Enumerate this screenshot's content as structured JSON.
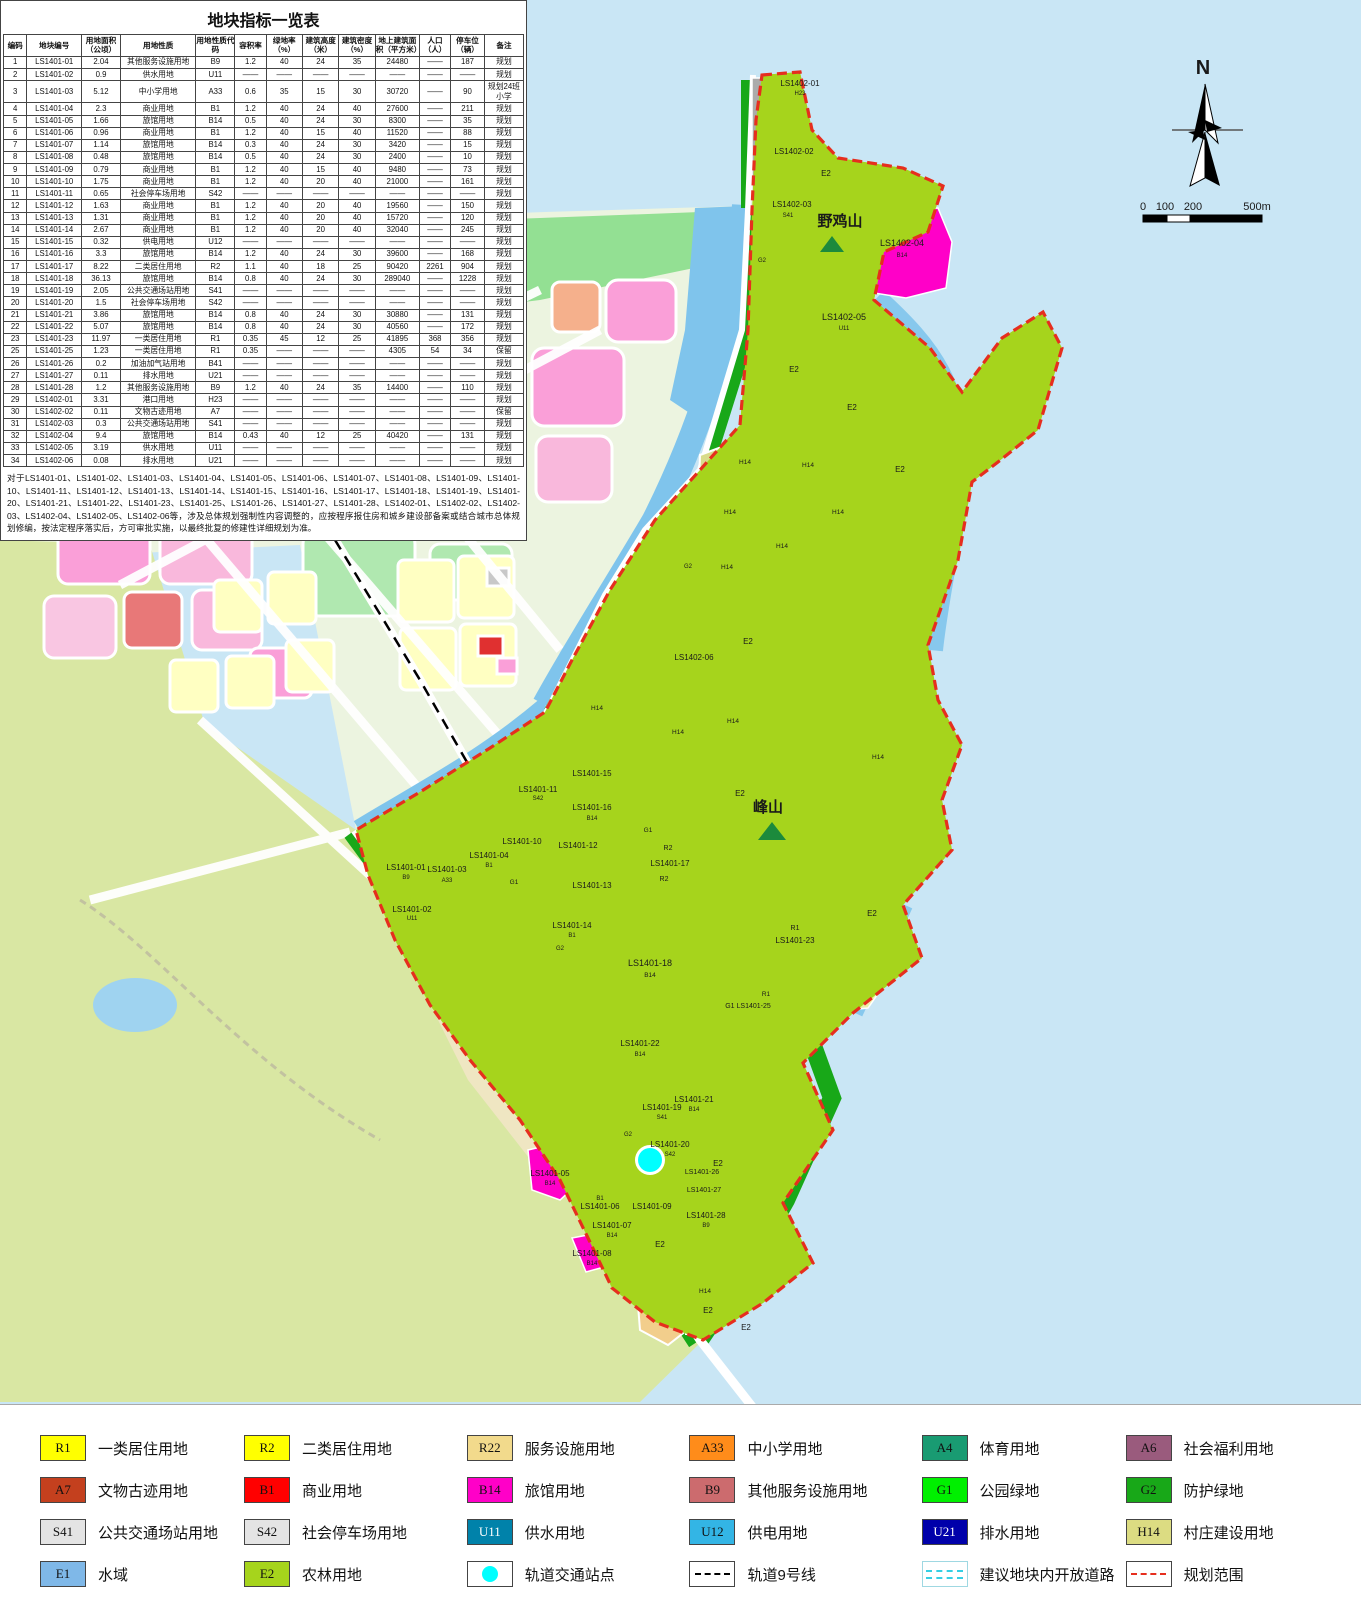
{
  "table": {
    "title": "地块指标一览表",
    "headers": [
      "编码",
      "地块编号",
      "用地面积（公顷）",
      "用地性质",
      "用地性质代码",
      "容积率",
      "绿地率（%）",
      "建筑高度（米）",
      "建筑密度（%）",
      "地上建筑面积（平方米）",
      "人口（人）",
      "停车位（辆）",
      "备注"
    ],
    "rows": [
      [
        "1",
        "LS1401-01",
        "2.04",
        "其他服务设施用地",
        "B9",
        "1.2",
        "40",
        "24",
        "35",
        "24480",
        "——",
        "187",
        "规划"
      ],
      [
        "2",
        "LS1401-02",
        "0.9",
        "供水用地",
        "U11",
        "——",
        "——",
        "——",
        "——",
        "——",
        "——",
        "——",
        "规划"
      ],
      [
        "3",
        "LS1401-03",
        "5.12",
        "中小学用地",
        "A33",
        "0.6",
        "35",
        "15",
        "30",
        "30720",
        "——",
        "90",
        "规划24班小学"
      ],
      [
        "4",
        "LS1401-04",
        "2.3",
        "商业用地",
        "B1",
        "1.2",
        "40",
        "24",
        "40",
        "27600",
        "——",
        "211",
        "规划"
      ],
      [
        "5",
        "LS1401-05",
        "1.66",
        "旅馆用地",
        "B14",
        "0.5",
        "40",
        "24",
        "30",
        "8300",
        "——",
        "35",
        "规划"
      ],
      [
        "6",
        "LS1401-06",
        "0.96",
        "商业用地",
        "B1",
        "1.2",
        "40",
        "15",
        "40",
        "11520",
        "——",
        "88",
        "规划"
      ],
      [
        "7",
        "LS1401-07",
        "1.14",
        "旅馆用地",
        "B14",
        "0.3",
        "40",
        "24",
        "30",
        "3420",
        "——",
        "15",
        "规划"
      ],
      [
        "8",
        "LS1401-08",
        "0.48",
        "旅馆用地",
        "B14",
        "0.5",
        "40",
        "24",
        "30",
        "2400",
        "——",
        "10",
        "规划"
      ],
      [
        "9",
        "LS1401-09",
        "0.79",
        "商业用地",
        "B1",
        "1.2",
        "40",
        "15",
        "40",
        "9480",
        "——",
        "73",
        "规划"
      ],
      [
        "10",
        "LS1401-10",
        "1.75",
        "商业用地",
        "B1",
        "1.2",
        "40",
        "20",
        "40",
        "21000",
        "——",
        "161",
        "规划"
      ],
      [
        "11",
        "LS1401-11",
        "0.65",
        "社会停车场用地",
        "S42",
        "——",
        "——",
        "——",
        "——",
        "——",
        "——",
        "——",
        "规划"
      ],
      [
        "12",
        "LS1401-12",
        "1.63",
        "商业用地",
        "B1",
        "1.2",
        "40",
        "20",
        "40",
        "19560",
        "——",
        "150",
        "规划"
      ],
      [
        "13",
        "LS1401-13",
        "1.31",
        "商业用地",
        "B1",
        "1.2",
        "40",
        "20",
        "40",
        "15720",
        "——",
        "120",
        "规划"
      ],
      [
        "14",
        "LS1401-14",
        "2.67",
        "商业用地",
        "B1",
        "1.2",
        "40",
        "20",
        "40",
        "32040",
        "——",
        "245",
        "规划"
      ],
      [
        "15",
        "LS1401-15",
        "0.32",
        "供电用地",
        "U12",
        "——",
        "——",
        "——",
        "——",
        "——",
        "——",
        "——",
        "规划"
      ],
      [
        "16",
        "LS1401-16",
        "3.3",
        "旅馆用地",
        "B14",
        "1.2",
        "40",
        "24",
        "30",
        "39600",
        "——",
        "168",
        "规划"
      ],
      [
        "17",
        "LS1401-17",
        "8.22",
        "二类居住用地",
        "R2",
        "1.1",
        "40",
        "18",
        "25",
        "90420",
        "2261",
        "904",
        "规划"
      ],
      [
        "18",
        "LS1401-18",
        "36.13",
        "旅馆用地",
        "B14",
        "0.8",
        "40",
        "24",
        "30",
        "289040",
        "——",
        "1228",
        "规划"
      ],
      [
        "19",
        "LS1401-19",
        "2.05",
        "公共交通场站用地",
        "S41",
        "——",
        "——",
        "——",
        "——",
        "——",
        "——",
        "——",
        "规划"
      ],
      [
        "20",
        "LS1401-20",
        "1.5",
        "社会停车场用地",
        "S42",
        "——",
        "——",
        "——",
        "——",
        "——",
        "——",
        "——",
        "规划"
      ],
      [
        "21",
        "LS1401-21",
        "3.86",
        "旅馆用地",
        "B14",
        "0.8",
        "40",
        "24",
        "30",
        "30880",
        "——",
        "131",
        "规划"
      ],
      [
        "22",
        "LS1401-22",
        "5.07",
        "旅馆用地",
        "B14",
        "0.8",
        "40",
        "24",
        "30",
        "40560",
        "——",
        "172",
        "规划"
      ],
      [
        "23",
        "LS1401-23",
        "11.97",
        "一类居住用地",
        "R1",
        "0.35",
        "45",
        "12",
        "25",
        "41895",
        "368",
        "356",
        "规划"
      ],
      [
        "25",
        "LS1401-25",
        "1.23",
        "一类居住用地",
        "R1",
        "0.35",
        "——",
        "——",
        "——",
        "4305",
        "54",
        "34",
        "保留"
      ],
      [
        "26",
        "LS1401-26",
        "0.2",
        "加油加气站用地",
        "B41",
        "——",
        "——",
        "——",
        "——",
        "——",
        "——",
        "——",
        "规划"
      ],
      [
        "27",
        "LS1401-27",
        "0.11",
        "排水用地",
        "U21",
        "——",
        "——",
        "——",
        "——",
        "——",
        "——",
        "——",
        "规划"
      ],
      [
        "28",
        "LS1401-28",
        "1.2",
        "其他服务设施用地",
        "B9",
        "1.2",
        "40",
        "24",
        "35",
        "14400",
        "——",
        "110",
        "规划"
      ],
      [
        "29",
        "LS1402-01",
        "3.31",
        "港口用地",
        "H23",
        "——",
        "——",
        "——",
        "——",
        "——",
        "——",
        "——",
        "规划"
      ],
      [
        "30",
        "LS1402-02",
        "0.11",
        "文物古迹用地",
        "A7",
        "——",
        "——",
        "——",
        "——",
        "——",
        "——",
        "——",
        "保留"
      ],
      [
        "31",
        "LS1402-03",
        "0.3",
        "公共交通场站用地",
        "S41",
        "——",
        "——",
        "——",
        "——",
        "——",
        "——",
        "——",
        "规划"
      ],
      [
        "32",
        "LS1402-04",
        "9.4",
        "旅馆用地",
        "B14",
        "0.43",
        "40",
        "12",
        "25",
        "40420",
        "——",
        "131",
        "规划"
      ],
      [
        "33",
        "LS1402-05",
        "3.19",
        "供水用地",
        "U11",
        "——",
        "——",
        "——",
        "——",
        "——",
        "——",
        "——",
        "规划"
      ],
      [
        "34",
        "LS1402-06",
        "0.08",
        "排水用地",
        "U21",
        "——",
        "——",
        "——",
        "——",
        "——",
        "——",
        "——",
        "规划"
      ]
    ]
  },
  "note": "对于LS1401-01、LS1401-02、LS1401-03、LS1401-04、LS1401-05、LS1401-06、LS1401-07、LS1401-08、LS1401-09、LS1401-10、LS1401-11、LS1401-12、LS1401-13、LS1401-14、LS1401-15、LS1401-16、LS1401-17、LS1401-18、LS1401-19、LS1401-20、LS1401-21、LS1401-22、LS1401-23、LS1401-25、LS1401-26、LS1401-27、LS1401-28、LS1402-01、LS1402-02、LS1402-03、LS1402-04、LS1402-05、LS1402-06等，涉及总体规划强制性内容调整的，应按程序报住房和城乡建设部备案或结合城市总体规划修编，按法定程序落实后，方可审批实施，以最终批复的修建性详细规划为准。",
  "legend": {
    "items": [
      {
        "code": "R1",
        "label": "一类居住用地",
        "color": "#FFFF00"
      },
      {
        "code": "R2",
        "label": "二类居住用地",
        "color": "#FFFF00"
      },
      {
        "code": "R22",
        "label": "服务设施用地",
        "color": "#F2DA8C"
      },
      {
        "code": "A33",
        "label": "中小学用地",
        "color": "#FF8C1A"
      },
      {
        "code": "A4",
        "label": "体育用地",
        "color": "#199B72"
      },
      {
        "code": "A6",
        "label": "社会福利用地",
        "color": "#9A5B7D"
      },
      {
        "code": "A7",
        "label": "文物古迹用地",
        "color": "#C4401E"
      },
      {
        "code": "B1",
        "label": "商业用地",
        "color": "#FF0000"
      },
      {
        "code": "B14",
        "label": "旅馆用地",
        "color": "#FF00C8"
      },
      {
        "code": "B9",
        "label": "其他服务设施用地",
        "color": "#CC6B6E"
      },
      {
        "code": "G1",
        "label": "公园绿地",
        "color": "#00F000"
      },
      {
        "code": "G2",
        "label": "防护绿地",
        "color": "#18A818"
      },
      {
        "code": "S41",
        "label": "公共交通场站用地",
        "color": "#E4E4E4"
      },
      {
        "code": "S42",
        "label": "社会停车场用地",
        "color": "#E4E4E4"
      },
      {
        "code": "U11",
        "label": "供水用地",
        "color": "#0082AA",
        "text": "#FFFFFF"
      },
      {
        "code": "U12",
        "label": "供电用地",
        "color": "#33B5E5"
      },
      {
        "code": "U21",
        "label": "排水用地",
        "color": "#0000AA",
        "text": "#FFFFFF"
      },
      {
        "code": "H14",
        "label": "村庄建设用地",
        "color": "#DCDC82"
      },
      {
        "code": "E1",
        "label": "水域",
        "color": "#7FB8E8"
      },
      {
        "code": "E2",
        "label": "农林用地",
        "color": "#A6D41C"
      },
      {
        "code": "",
        "label": "轨道交通站点",
        "type": "station"
      },
      {
        "code": "",
        "label": "轨道9号线",
        "type": "rail"
      },
      {
        "code": "",
        "label": "建议地块内开放道路",
        "type": "openroad"
      },
      {
        "code": "",
        "label": "规划范围",
        "type": "boundary"
      }
    ]
  },
  "map": {
    "labels": [
      {
        "t": "N",
        "x": 1203,
        "y": 74,
        "s": 20,
        "b": 1
      },
      {
        "t": "0",
        "x": 1143,
        "y": 210,
        "s": 11
      },
      {
        "t": "100",
        "x": 1165,
        "y": 210,
        "s": 11
      },
      {
        "t": "200",
        "x": 1193,
        "y": 210,
        "s": 11
      },
      {
        "t": "500m",
        "x": 1257,
        "y": 210,
        "s": 11
      },
      {
        "t": "野鸡山",
        "x": 840,
        "y": 226,
        "s": 15,
        "b": 1
      },
      {
        "t": "峰山",
        "x": 768,
        "y": 812,
        "s": 15,
        "b": 1
      },
      {
        "t": "LS1402-01",
        "x": 800,
        "y": 86
      },
      {
        "t": "H23",
        "x": 800,
        "y": 95,
        "s": 6
      },
      {
        "t": "LS1402-02",
        "x": 794,
        "y": 154
      },
      {
        "t": "LS1402-03",
        "x": 792,
        "y": 207
      },
      {
        "t": "S41",
        "x": 788,
        "y": 217,
        "s": 6
      },
      {
        "t": "LS1402-04",
        "x": 902,
        "y": 246,
        "s": 9
      },
      {
        "t": "B14",
        "x": 902,
        "y": 257,
        "s": 6
      },
      {
        "t": "LS1402-05",
        "x": 844,
        "y": 320,
        "s": 9
      },
      {
        "t": "U11",
        "x": 844,
        "y": 330,
        "s": 6
      },
      {
        "t": "LS1402-06",
        "x": 694,
        "y": 660
      },
      {
        "t": "E2",
        "x": 826,
        "y": 176
      },
      {
        "t": "E2",
        "x": 794,
        "y": 372
      },
      {
        "t": "E2",
        "x": 852,
        "y": 410
      },
      {
        "t": "E2",
        "x": 900,
        "y": 472
      },
      {
        "t": "E2",
        "x": 748,
        "y": 644
      },
      {
        "t": "E2",
        "x": 740,
        "y": 796
      },
      {
        "t": "E2",
        "x": 872,
        "y": 916
      },
      {
        "t": "E2",
        "x": 718,
        "y": 1166
      },
      {
        "t": "E2",
        "x": 660,
        "y": 1247
      },
      {
        "t": "E2",
        "x": 708,
        "y": 1313
      },
      {
        "t": "E2",
        "x": 746,
        "y": 1330
      },
      {
        "t": "G2",
        "x": 762,
        "y": 262,
        "s": 6
      },
      {
        "t": "G2",
        "x": 688,
        "y": 568,
        "s": 6
      },
      {
        "t": "G2",
        "x": 560,
        "y": 950,
        "s": 6
      },
      {
        "t": "G2",
        "x": 628,
        "y": 1136,
        "s": 6
      },
      {
        "t": "H14",
        "x": 745,
        "y": 464,
        "s": 6.5
      },
      {
        "t": "H14",
        "x": 808,
        "y": 467,
        "s": 6.5
      },
      {
        "t": "H14",
        "x": 730,
        "y": 514,
        "s": 6.5
      },
      {
        "t": "H14",
        "x": 838,
        "y": 514,
        "s": 6.5
      },
      {
        "t": "H14",
        "x": 782,
        "y": 548,
        "s": 6.5
      },
      {
        "t": "H14",
        "x": 727,
        "y": 569,
        "s": 6.5
      },
      {
        "t": "H14",
        "x": 597,
        "y": 710,
        "s": 6.5
      },
      {
        "t": "H14",
        "x": 678,
        "y": 734,
        "s": 6.5
      },
      {
        "t": "H14",
        "x": 733,
        "y": 723,
        "s": 6.5
      },
      {
        "t": "H14",
        "x": 878,
        "y": 759,
        "s": 6.5
      },
      {
        "t": "H14",
        "x": 705,
        "y": 1293,
        "s": 6.5
      },
      {
        "t": "LS1401-15",
        "x": 592,
        "y": 776
      },
      {
        "t": "LS1401-16",
        "x": 592,
        "y": 810
      },
      {
        "t": "B14",
        "x": 592,
        "y": 820,
        "s": 6
      },
      {
        "t": "G1",
        "x": 648,
        "y": 832,
        "s": 6.5
      },
      {
        "t": "G1",
        "x": 514,
        "y": 884,
        "s": 6.5
      },
      {
        "t": "R2",
        "x": 668,
        "y": 850,
        "s": 7
      },
      {
        "t": "LS1401-17",
        "x": 670,
        "y": 866
      },
      {
        "t": "R2",
        "x": 664,
        "y": 881,
        "s": 7
      },
      {
        "t": "LS1401-12",
        "x": 578,
        "y": 848
      },
      {
        "t": "LS1401-13",
        "x": 592,
        "y": 888
      },
      {
        "t": "LS1401-14",
        "x": 572,
        "y": 928
      },
      {
        "t": "B1",
        "x": 572,
        "y": 937,
        "s": 6
      },
      {
        "t": "LS1401-10",
        "x": 522,
        "y": 844
      },
      {
        "t": "LS1401-11",
        "x": 538,
        "y": 792
      },
      {
        "t": "S42",
        "x": 538,
        "y": 800,
        "s": 6
      },
      {
        "t": "LS1401-01",
        "x": 406,
        "y": 870
      },
      {
        "t": "B9",
        "x": 406,
        "y": 879,
        "s": 6
      },
      {
        "t": "LS1401-02",
        "x": 412,
        "y": 912
      },
      {
        "t": "U11",
        "x": 412,
        "y": 920,
        "s": 6
      },
      {
        "t": "LS1401-03",
        "x": 447,
        "y": 872
      },
      {
        "t": "A33",
        "x": 447,
        "y": 882,
        "s": 6
      },
      {
        "t": "LS1401-04",
        "x": 489,
        "y": 858
      },
      {
        "t": "B1",
        "x": 489,
        "y": 867,
        "s": 6
      },
      {
        "t": "LS1401-18",
        "x": 650,
        "y": 966,
        "s": 9
      },
      {
        "t": "B14",
        "x": 650,
        "y": 977,
        "s": 6.5
      },
      {
        "t": "R1",
        "x": 795,
        "y": 930,
        "s": 7
      },
      {
        "t": "LS1401-23",
        "x": 795,
        "y": 943
      },
      {
        "t": "R1",
        "x": 766,
        "y": 996,
        "s": 6.5
      },
      {
        "t": "G1 LS1401-25",
        "x": 748,
        "y": 1008,
        "s": 7
      },
      {
        "t": "LS1401-22",
        "x": 640,
        "y": 1046
      },
      {
        "t": "B14",
        "x": 640,
        "y": 1056,
        "s": 6
      },
      {
        "t": "LS1401-21",
        "x": 694,
        "y": 1102
      },
      {
        "t": "B14",
        "x": 694,
        "y": 1111,
        "s": 6
      },
      {
        "t": "LS1401-19",
        "x": 662,
        "y": 1110
      },
      {
        "t": "S41",
        "x": 662,
        "y": 1119,
        "s": 6
      },
      {
        "t": "LS1401-20",
        "x": 670,
        "y": 1147
      },
      {
        "t": "S42",
        "x": 670,
        "y": 1156,
        "s": 6
      },
      {
        "t": "LS1401-26",
        "x": 702,
        "y": 1174,
        "s": 7
      },
      {
        "t": "LS1401-27",
        "x": 704,
        "y": 1192,
        "s": 7
      },
      {
        "t": "LS1401-28",
        "x": 706,
        "y": 1218
      },
      {
        "t": "B9",
        "x": 706,
        "y": 1227,
        "s": 6
      },
      {
        "t": "LS1401-05",
        "x": 550,
        "y": 1176
      },
      {
        "t": "B14",
        "x": 550,
        "y": 1185,
        "s": 6
      },
      {
        "t": "B1",
        "x": 600,
        "y": 1200,
        "s": 6
      },
      {
        "t": "LS1401-06",
        "x": 600,
        "y": 1209
      },
      {
        "t": "LS1401-09",
        "x": 652,
        "y": 1209
      },
      {
        "t": "LS1401-07",
        "x": 612,
        "y": 1228
      },
      {
        "t": "B14",
        "x": 612,
        "y": 1237,
        "s": 6
      },
      {
        "t": "LS1401-08",
        "x": 592,
        "y": 1256
      },
      {
        "t": "B14",
        "x": 592,
        "y": 1265,
        "s": 6
      }
    ]
  }
}
